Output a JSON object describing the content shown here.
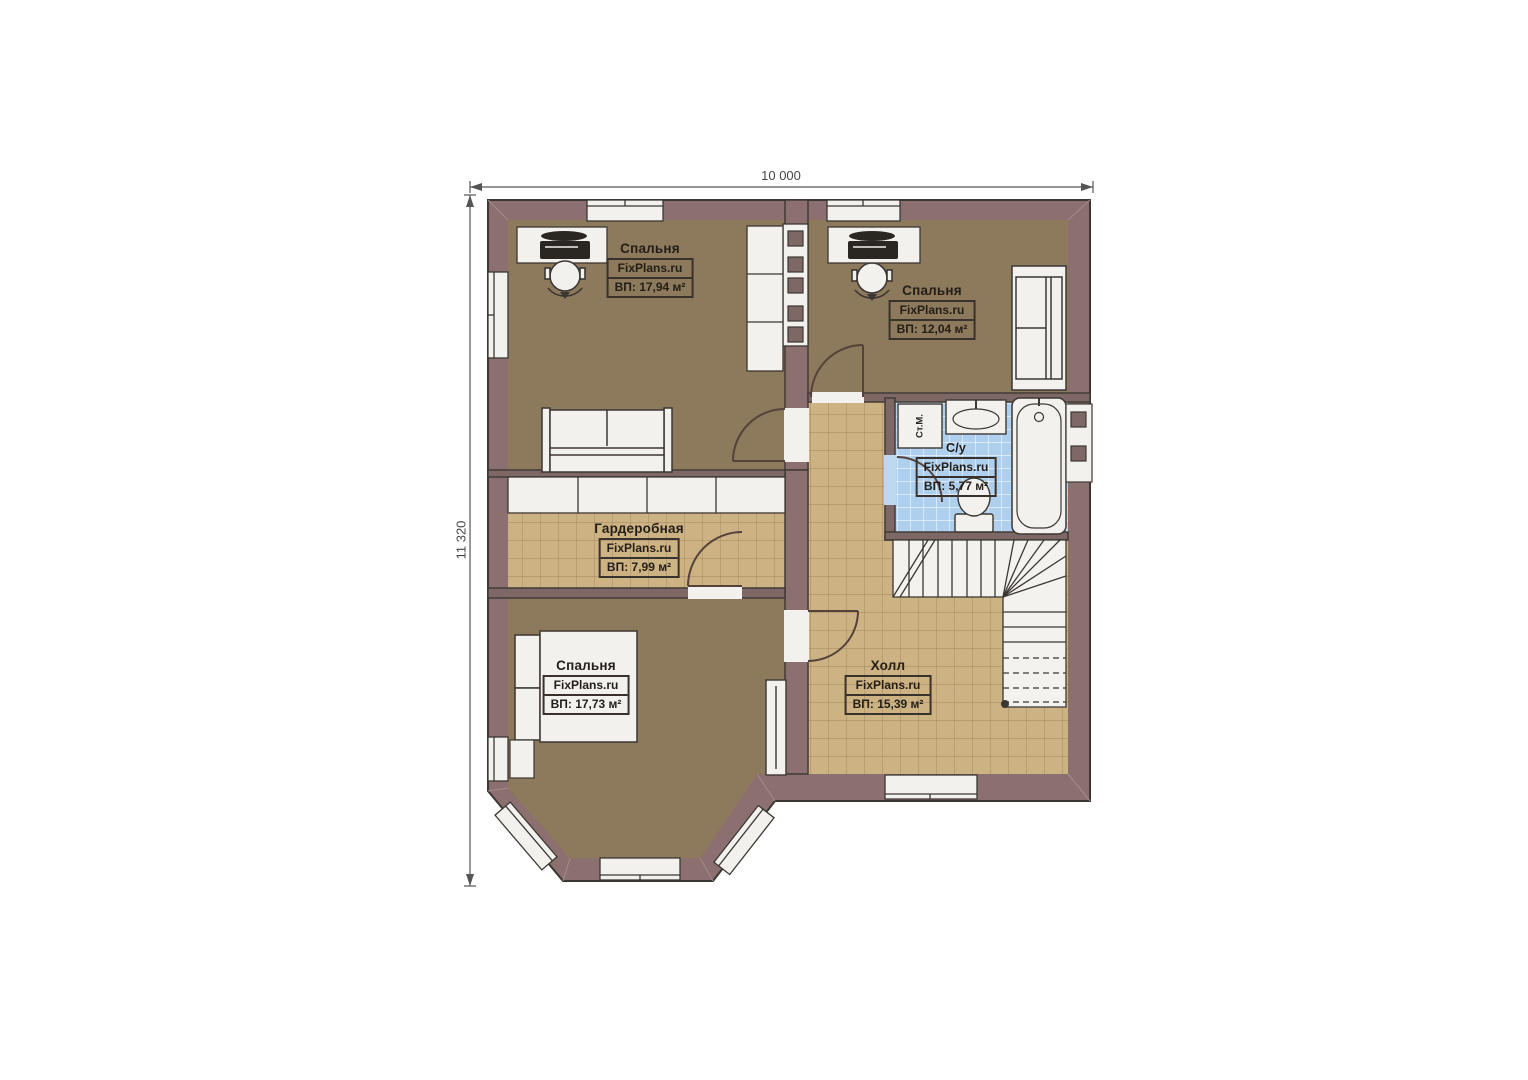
{
  "plan": {
    "dimensions": {
      "width_label": "10 000",
      "height_label": "11 320"
    },
    "rooms": [
      {
        "key": "bedroom-top-left",
        "title": "Спальня",
        "watermark": "FixPlans.ru",
        "area": "ВП: 17,94 м²"
      },
      {
        "key": "bedroom-top-right",
        "title": "Спальня",
        "watermark": "FixPlans.ru",
        "area": "ВП: 12,04 м²"
      },
      {
        "key": "bathroom",
        "title": "С/у",
        "watermark": "FixPlans.ru",
        "area": "ВП: 5,77 м²"
      },
      {
        "key": "wardrobe",
        "title": "Гардеробная",
        "watermark": "FixPlans.ru",
        "area": "ВП: 7,99 м²"
      },
      {
        "key": "bedroom-bottom",
        "title": "Спальня",
        "watermark": "FixPlans.ru",
        "area": "ВП: 17,73 м²"
      },
      {
        "key": "hall",
        "title": "Холл",
        "watermark": "FixPlans.ru",
        "area": "ВП: 15,39 м²"
      }
    ],
    "appliances": {
      "washing_machine_label": "Ст.М."
    },
    "colors": {
      "wall": "#8c7070",
      "interior_wall": "#7d6866",
      "bedroom_floor": "#8d795b",
      "tile_floor": "#cdb384",
      "bath_tile": "#aed0ee",
      "fixture_white": "#f2f1ee",
      "outline": "#3c3733"
    }
  }
}
